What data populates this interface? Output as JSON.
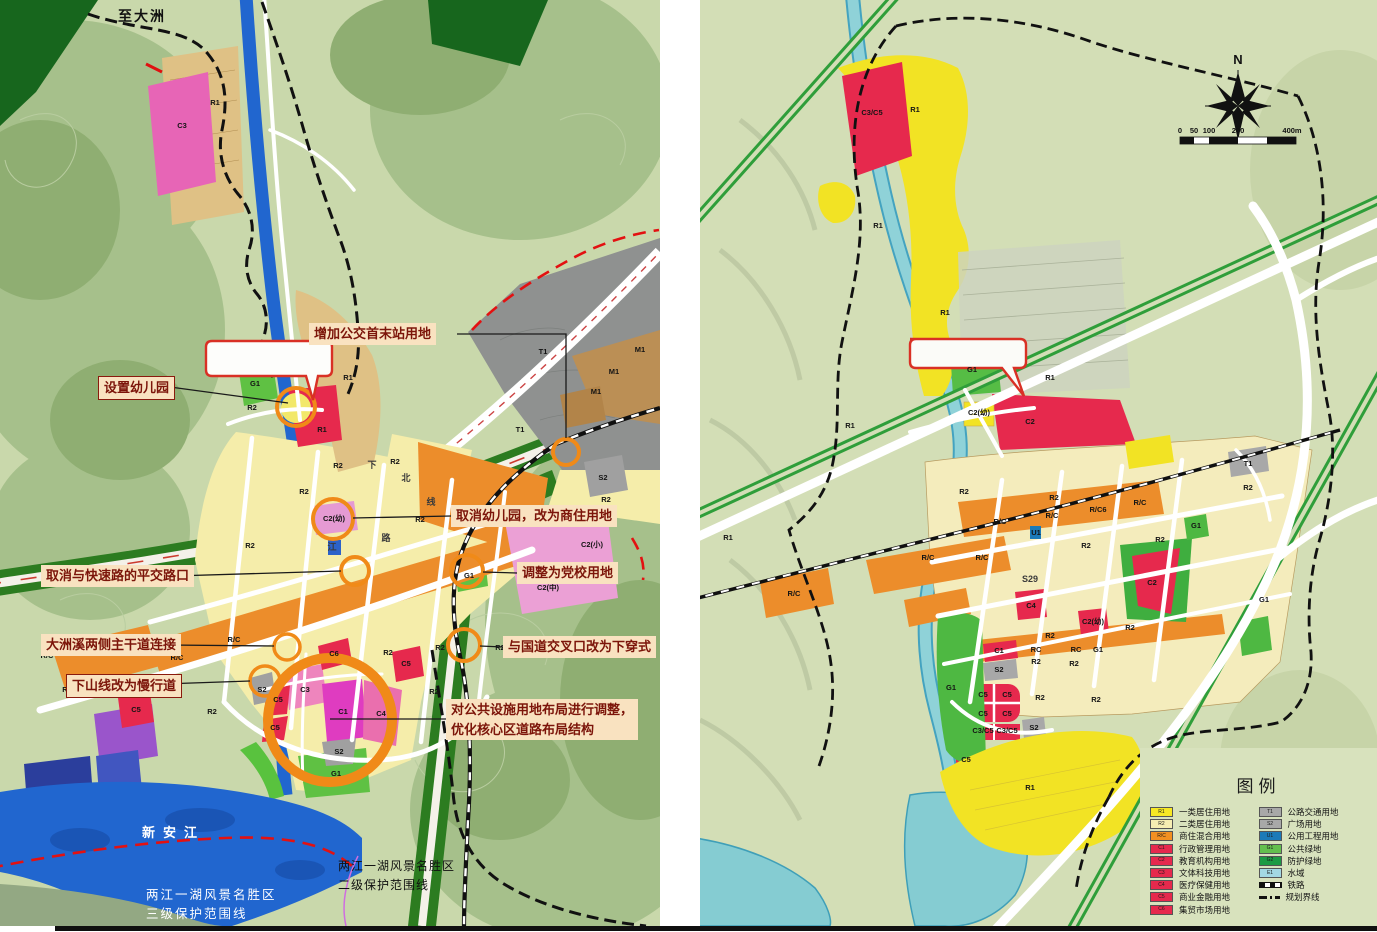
{
  "style_colors": {
    "annotation_bg": "#f9e2c0",
    "annotation_text": "#7c150a",
    "highlight_circle": "#f08a18",
    "bubble_border": "#d93025",
    "legend_bg": "#d8e2bd"
  },
  "left_map": {
    "route_label": "至大洲",
    "river_label": "新安江",
    "protection3": [
      "两江一湖风景名胜区",
      "三级保护范围线"
    ],
    "protection2": [
      "两江一湖风景名胜区",
      "二级保护范围线"
    ],
    "annotations": [
      {
        "x": 309,
        "y": 323,
        "boxed": false,
        "lines": [
          "增加公交首末站用地"
        ]
      },
      {
        "x": 98,
        "y": 376,
        "boxed": true,
        "lines": [
          "设置幼儿园"
        ]
      },
      {
        "x": 451,
        "y": 505,
        "boxed": false,
        "lines": [
          "取消幼儿园，改为商住用地"
        ]
      },
      {
        "x": 517,
        "y": 562,
        "boxed": false,
        "lines": [
          "调整为党校用地"
        ]
      },
      {
        "x": 41,
        "y": 565,
        "boxed": false,
        "lines": [
          "取消与快速路的平交路口"
        ]
      },
      {
        "x": 41,
        "y": 634,
        "boxed": false,
        "lines": [
          "大洲溪两侧主干道连接"
        ]
      },
      {
        "x": 66,
        "y": 674,
        "boxed": true,
        "lines": [
          "下山线改为慢行道"
        ]
      },
      {
        "x": 503,
        "y": 636,
        "boxed": false,
        "lines": [
          "与国道交叉口改为下穿式"
        ]
      },
      {
        "x": 446,
        "y": 699,
        "boxed": false,
        "lines": [
          "对公共设施用地布局进行调整，",
          "优化核心区道路布局结构"
        ]
      }
    ],
    "zone_labels": [
      {
        "t": "C3",
        "x": 182,
        "y": 128
      },
      {
        "t": "R1",
        "x": 215,
        "y": 105
      },
      {
        "t": "R1",
        "x": 348,
        "y": 380
      },
      {
        "t": "G1",
        "x": 255,
        "y": 386
      },
      {
        "t": "R2",
        "x": 252,
        "y": 410
      },
      {
        "t": "R1",
        "x": 322,
        "y": 432
      },
      {
        "t": "R2",
        "x": 338,
        "y": 468
      },
      {
        "t": "R2",
        "x": 395,
        "y": 464
      },
      {
        "t": "R2",
        "x": 304,
        "y": 494
      },
      {
        "t": "R2",
        "x": 250,
        "y": 548
      },
      {
        "t": "R2",
        "x": 420,
        "y": 522
      },
      {
        "t": "C2(幼)",
        "x": 334,
        "y": 521
      },
      {
        "t": "T1",
        "x": 543,
        "y": 354
      },
      {
        "t": "T1",
        "x": 520,
        "y": 432
      },
      {
        "t": "M1",
        "x": 614,
        "y": 374
      },
      {
        "t": "M1",
        "x": 640,
        "y": 352
      },
      {
        "t": "M1",
        "x": 596,
        "y": 394
      },
      {
        "t": "S2",
        "x": 603,
        "y": 480
      },
      {
        "t": "R2",
        "x": 606,
        "y": 502
      },
      {
        "t": "C2(小)",
        "x": 592,
        "y": 547
      },
      {
        "t": "C2(中)",
        "x": 548,
        "y": 590
      },
      {
        "t": "G1",
        "x": 469,
        "y": 578
      },
      {
        "t": "R/C",
        "x": 47,
        "y": 658
      },
      {
        "t": "R/C",
        "x": 177,
        "y": 660
      },
      {
        "t": "R/C",
        "x": 234,
        "y": 642
      },
      {
        "t": "R/C",
        "x": 462,
        "y": 527
      },
      {
        "t": "R2",
        "x": 67,
        "y": 692
      },
      {
        "t": "R2",
        "x": 130,
        "y": 690
      },
      {
        "t": "R2",
        "x": 212,
        "y": 714
      },
      {
        "t": "C5",
        "x": 136,
        "y": 712
      },
      {
        "t": "C6",
        "x": 334,
        "y": 656
      },
      {
        "t": "C5",
        "x": 406,
        "y": 666
      },
      {
        "t": "C5",
        "x": 278,
        "y": 702
      },
      {
        "t": "C5",
        "x": 275,
        "y": 730
      },
      {
        "t": "C3",
        "x": 305,
        "y": 692
      },
      {
        "t": "C1",
        "x": 343,
        "y": 714
      },
      {
        "t": "C4",
        "x": 381,
        "y": 716
      },
      {
        "t": "S2",
        "x": 339,
        "y": 754
      },
      {
        "t": "S2",
        "x": 262,
        "y": 692
      },
      {
        "t": "G1",
        "x": 336,
        "y": 776
      },
      {
        "t": "R2",
        "x": 388,
        "y": 655
      },
      {
        "t": "R2",
        "x": 440,
        "y": 650
      },
      {
        "t": "R2",
        "x": 500,
        "y": 650
      },
      {
        "t": "R2",
        "x": 434,
        "y": 694
      },
      {
        "t": "下",
        "x": 372,
        "y": 468,
        "road": true
      },
      {
        "t": "北",
        "x": 406,
        "y": 481,
        "road": true
      },
      {
        "t": "线",
        "x": 431,
        "y": 505,
        "road": true
      },
      {
        "t": "路",
        "x": 386,
        "y": 541,
        "road": true
      },
      {
        "t": "江",
        "x": 332,
        "y": 550,
        "road": true
      }
    ]
  },
  "right_map": {
    "compass_label": "N",
    "scale_ticks": [
      "0",
      "50",
      "100",
      "200",
      "400m"
    ],
    "legend": {
      "title": "图例",
      "left": [
        {
          "code": "R1",
          "color": "#f7e824",
          "label": "一类居住用地"
        },
        {
          "code": "R2",
          "color": "#f6eeb2",
          "label": "二类居住用地"
        },
        {
          "code": "R/C",
          "color": "#f29022",
          "label": "商住混合用地"
        },
        {
          "code": "C1",
          "color": "#e6294d",
          "label": "行政管理用地"
        },
        {
          "code": "C2",
          "color": "#e6294d",
          "label": "教育机构用地"
        },
        {
          "code": "C3",
          "color": "#e6294d",
          "label": "文体科技用地"
        },
        {
          "code": "C4",
          "color": "#e6294d",
          "label": "医疗保健用地"
        },
        {
          "code": "C5",
          "color": "#e6294d",
          "label": "商业金融用地"
        },
        {
          "code": "C6",
          "color": "#e6294d",
          "label": "集贸市场用地"
        }
      ],
      "right": [
        {
          "code": "T1",
          "color": "#a8a8a8",
          "label": "公路交通用地"
        },
        {
          "code": "S2",
          "color": "#a8a8a8",
          "label": "广场用地"
        },
        {
          "code": "U1",
          "color": "#1b7ab8",
          "label": "公用工程用地"
        },
        {
          "code": "G1",
          "color": "#63bf4e",
          "label": "公共绿地"
        },
        {
          "code": "G2",
          "color": "#1d9a44",
          "label": "防护绿地"
        },
        {
          "code": "E1",
          "color": "#a3d8e3",
          "label": "水域"
        },
        {
          "type": "railway",
          "label": "铁路"
        },
        {
          "type": "boundary",
          "label": "规划界线"
        }
      ]
    },
    "zone_labels": [
      {
        "t": "C3/C5",
        "x": 172,
        "y": 115
      },
      {
        "t": "R1",
        "x": 215,
        "y": 112
      },
      {
        "t": "R1",
        "x": 178,
        "y": 228
      },
      {
        "t": "R1",
        "x": 245,
        "y": 315
      },
      {
        "t": "G1",
        "x": 272,
        "y": 372
      },
      {
        "t": "R1",
        "x": 350,
        "y": 380
      },
      {
        "t": "C2(幼)",
        "x": 279,
        "y": 415
      },
      {
        "t": "C2",
        "x": 330,
        "y": 424
      },
      {
        "t": "R1",
        "x": 150,
        "y": 428
      },
      {
        "t": "T1",
        "x": 548,
        "y": 466
      },
      {
        "t": "R2",
        "x": 264,
        "y": 494
      },
      {
        "t": "R2",
        "x": 354,
        "y": 500
      },
      {
        "t": "R2",
        "x": 548,
        "y": 490
      },
      {
        "t": "G1",
        "x": 496,
        "y": 528
      },
      {
        "t": "R/C",
        "x": 300,
        "y": 524
      },
      {
        "t": "R/C",
        "x": 352,
        "y": 518
      },
      {
        "t": "R/C6",
        "x": 398,
        "y": 512
      },
      {
        "t": "R/C",
        "x": 440,
        "y": 505
      },
      {
        "t": "U1",
        "x": 336,
        "y": 535
      },
      {
        "t": "R/C",
        "x": 282,
        "y": 560
      },
      {
        "t": "R/C",
        "x": 228,
        "y": 560
      },
      {
        "t": "R/C",
        "x": 94,
        "y": 596
      },
      {
        "t": "R1",
        "x": 28,
        "y": 540
      },
      {
        "t": "C2",
        "x": 452,
        "y": 585
      },
      {
        "t": "G1",
        "x": 564,
        "y": 602
      },
      {
        "t": "C4",
        "x": 331,
        "y": 608
      },
      {
        "t": "C2(幼)",
        "x": 393,
        "y": 624
      },
      {
        "t": "R2",
        "x": 386,
        "y": 548
      },
      {
        "t": "R2",
        "x": 460,
        "y": 542
      },
      {
        "t": "R2",
        "x": 350,
        "y": 638
      },
      {
        "t": "R2",
        "x": 430,
        "y": 630
      },
      {
        "t": "RC",
        "x": 336,
        "y": 652
      },
      {
        "t": "RC",
        "x": 376,
        "y": 652
      },
      {
        "t": "G1",
        "x": 398,
        "y": 652
      },
      {
        "t": "C1",
        "x": 299,
        "y": 653
      },
      {
        "t": "S2",
        "x": 299,
        "y": 672
      },
      {
        "t": "G1",
        "x": 251,
        "y": 690
      },
      {
        "t": "C5",
        "x": 283,
        "y": 697
      },
      {
        "t": "C5",
        "x": 307,
        "y": 697
      },
      {
        "t": "C5",
        "x": 283,
        "y": 716
      },
      {
        "t": "C5",
        "x": 307,
        "y": 716
      },
      {
        "t": "R2",
        "x": 336,
        "y": 664
      },
      {
        "t": "R2",
        "x": 374,
        "y": 666
      },
      {
        "t": "C3/C5",
        "x": 283,
        "y": 733
      },
      {
        "t": "C3/C5",
        "x": 307,
        "y": 733
      },
      {
        "t": "S2",
        "x": 334,
        "y": 730
      },
      {
        "t": "C5",
        "x": 266,
        "y": 762
      },
      {
        "t": "R1",
        "x": 330,
        "y": 790
      },
      {
        "t": "R2",
        "x": 340,
        "y": 700
      },
      {
        "t": "R2",
        "x": 396,
        "y": 702
      },
      {
        "t": "S29",
        "x": 330,
        "y": 582,
        "road": true
      }
    ]
  }
}
